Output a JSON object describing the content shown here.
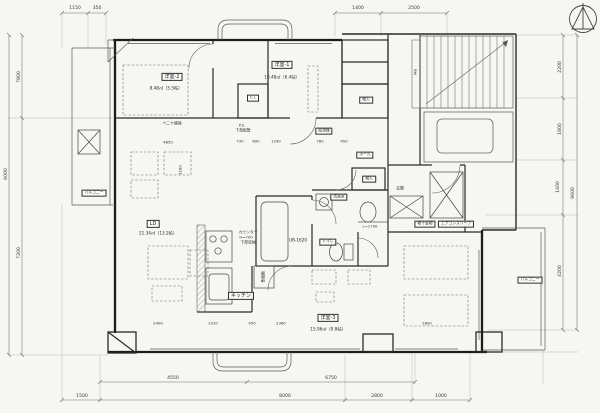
{
  "meta": {
    "drawing_type": "apartment floor plan (scanned architectural drawing)",
    "paper_color": "#f6f6f3",
    "line_color": "#2a2a2a"
  },
  "rooms": [
    {
      "label": "洋室-2",
      "area": "8.48㎡（5.5帖）"
    },
    {
      "label": "洋室-1",
      "area": "10.48㎡（6.4帖）"
    },
    {
      "label": "LD",
      "area": "21.34㎡（13.2帖）"
    },
    {
      "label": "洋室-3",
      "area": "15.96㎡（9.8帖）"
    }
  ],
  "fixtures": {
    "kitchen": "キッチン",
    "bath": "UB-1620",
    "washroom": "洗面室",
    "toilet": "トイレ",
    "hall": "ホール",
    "closet_upper": "物入",
    "closet_hall": "物入",
    "cl": "C.L",
    "entrance": "玄関",
    "water_heater": "給湯器",
    "dish_shelf": "食器棚",
    "counter_line1": "カウンター",
    "counter_line2": "H=700",
    "counter_line3": "下部収納",
    "veneer": "ベニヤ補強",
    "ps": "P.S.",
    "pipe": "下部配管",
    "hanger": "物干金物",
    "ac_sleeve": "エアコンスリーブ",
    "linen": "L=1790",
    "meter_box": "MB"
  },
  "balconies": {
    "left": "バルコニー",
    "right": "バルコニー"
  },
  "dimensions": {
    "top": [
      "1150",
      "350",
      "1400",
      "2500"
    ],
    "bottom_upper": [
      "4550",
      "6750"
    ],
    "bottom_lower": [
      "1500",
      "8000",
      "2800",
      "1000"
    ],
    "left": [
      "7800",
      "6000",
      "7200"
    ],
    "right": [
      "2200",
      "1800",
      "1400",
      "9600",
      "4200"
    ],
    "interior": [
      "4650",
      "730",
      "690",
      "1240",
      "780",
      "450",
      "3180",
      "2400",
      "1010",
      "450",
      "2360",
      "2800"
    ]
  }
}
